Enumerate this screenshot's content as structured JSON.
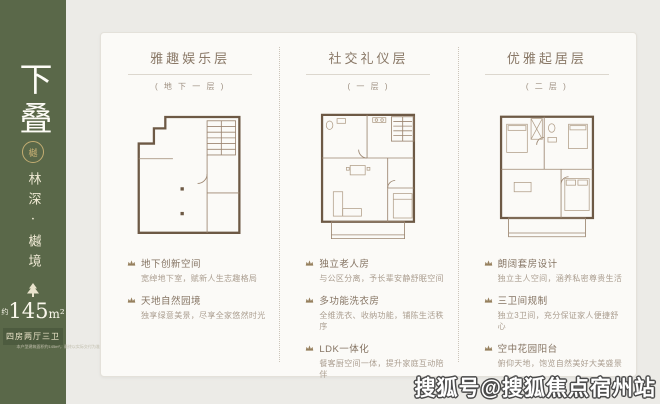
{
  "colors": {
    "panel_green": "#5a6849",
    "banner_green": "#4d5b3f",
    "card_bg": "#fbfaf7",
    "page_bg": "#ecebe7",
    "title_brown": "#8a7968",
    "plan_wall": "#6d5945",
    "gold": "#c3ad72"
  },
  "sidebar": {
    "title_vertical": "下叠",
    "seal_char": "樾",
    "subtitle_vertical": "林深·樾境",
    "tree_icon": "pine-tree",
    "area_prefix": "约",
    "area_number": "145",
    "area_unit": "m²",
    "spec_banner": "四房两厅三卫",
    "disclaimer": "本户型建筑面积约145m²，最终以实际交付为准"
  },
  "floors": [
    {
      "title": "雅趣娱乐层",
      "subtitle": "( 地 下 一 层 )",
      "features": [
        {
          "title": "地下创新空间",
          "desc": "宽绰地下室，赋新人生志趣格局"
        },
        {
          "title": "天地自然园境",
          "desc": "独享绿意美景，尽享全家悠然时光"
        }
      ]
    },
    {
      "title": "社交礼仪层",
      "subtitle": "( 一 层 )",
      "features": [
        {
          "title": "独立老人房",
          "desc": "与公区分离，予长辈安静舒眠空间"
        },
        {
          "title": "多功能洗衣房",
          "desc": "全维洗衣、收纳功能，铺陈生活秩序"
        },
        {
          "title": "LDK一体化",
          "desc": "餐客厨空间一体，提升家庭互动陪伴"
        }
      ]
    },
    {
      "title": "优雅起居层",
      "subtitle": "( 二 层 )",
      "features": [
        {
          "title": "朗阔套房设计",
          "desc": "独立主人空间，涵养私密尊贵生活"
        },
        {
          "title": "三卫间规制",
          "desc": "独立3卫间，充分保证家人便捷舒心"
        },
        {
          "title": "空中花园阳台",
          "desc": "俯仰天地，饱览自然美好大美盛景"
        }
      ]
    }
  ],
  "watermark": "搜狐号@搜狐焦点宿州站"
}
